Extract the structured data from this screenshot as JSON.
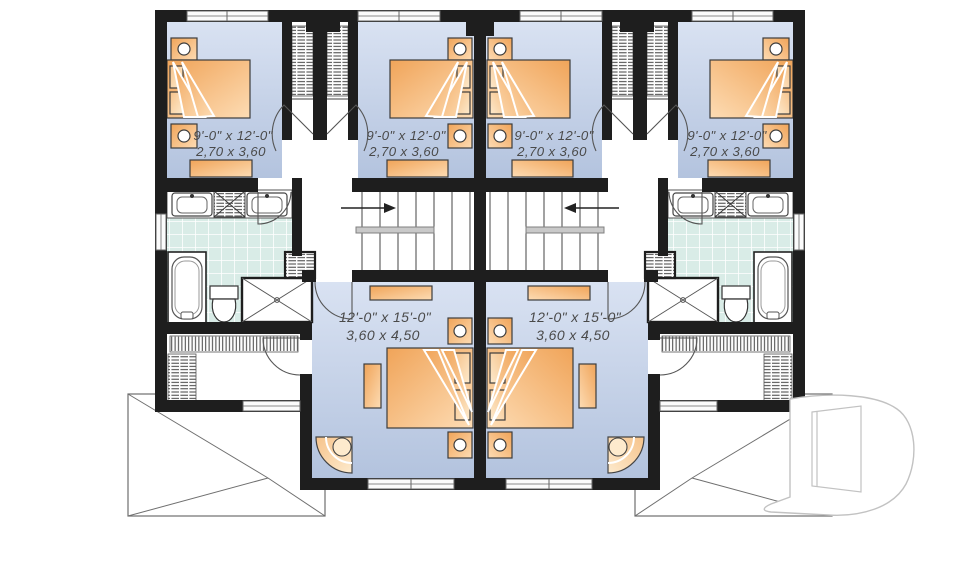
{
  "plan": {
    "type": "duplex-second-floor-plan",
    "units": 2,
    "labels": {
      "bedroom_left_outer": {
        "imperial": "9'-0\" x 12'-0\"",
        "metric": "2,70 x 3,60"
      },
      "bedroom_left_inner": {
        "imperial": "9'-0\" x 12'-0\"",
        "metric": "2,70 x 3,60"
      },
      "bedroom_right_inner": {
        "imperial": "9'-0\" x 12'-0\"",
        "metric": "2,70 x 3,60"
      },
      "bedroom_right_outer": {
        "imperial": "9'-0\" x 12'-0\"",
        "metric": "2,70 x 3,60"
      },
      "master_left": {
        "imperial": "12'-0\" x 15'-0\"",
        "metric": "3,60 x 4,50"
      },
      "master_right": {
        "imperial": "12'-0\" x 15'-0\"",
        "metric": "3,60 x 4,50"
      }
    },
    "watermark": {
      "logo": "D"
    },
    "colors": {
      "wall": "#1e1e1e",
      "room_blue_light": "#d9e2f2",
      "room_blue_dark": "#b3c3de",
      "furniture_orange": "#f0a459",
      "furniture_orange_light": "#fddcb4",
      "bath_tile": "#d9ece7",
      "label_text": "#4a4a4a",
      "watermark_stroke": "#c2c2c2"
    }
  }
}
